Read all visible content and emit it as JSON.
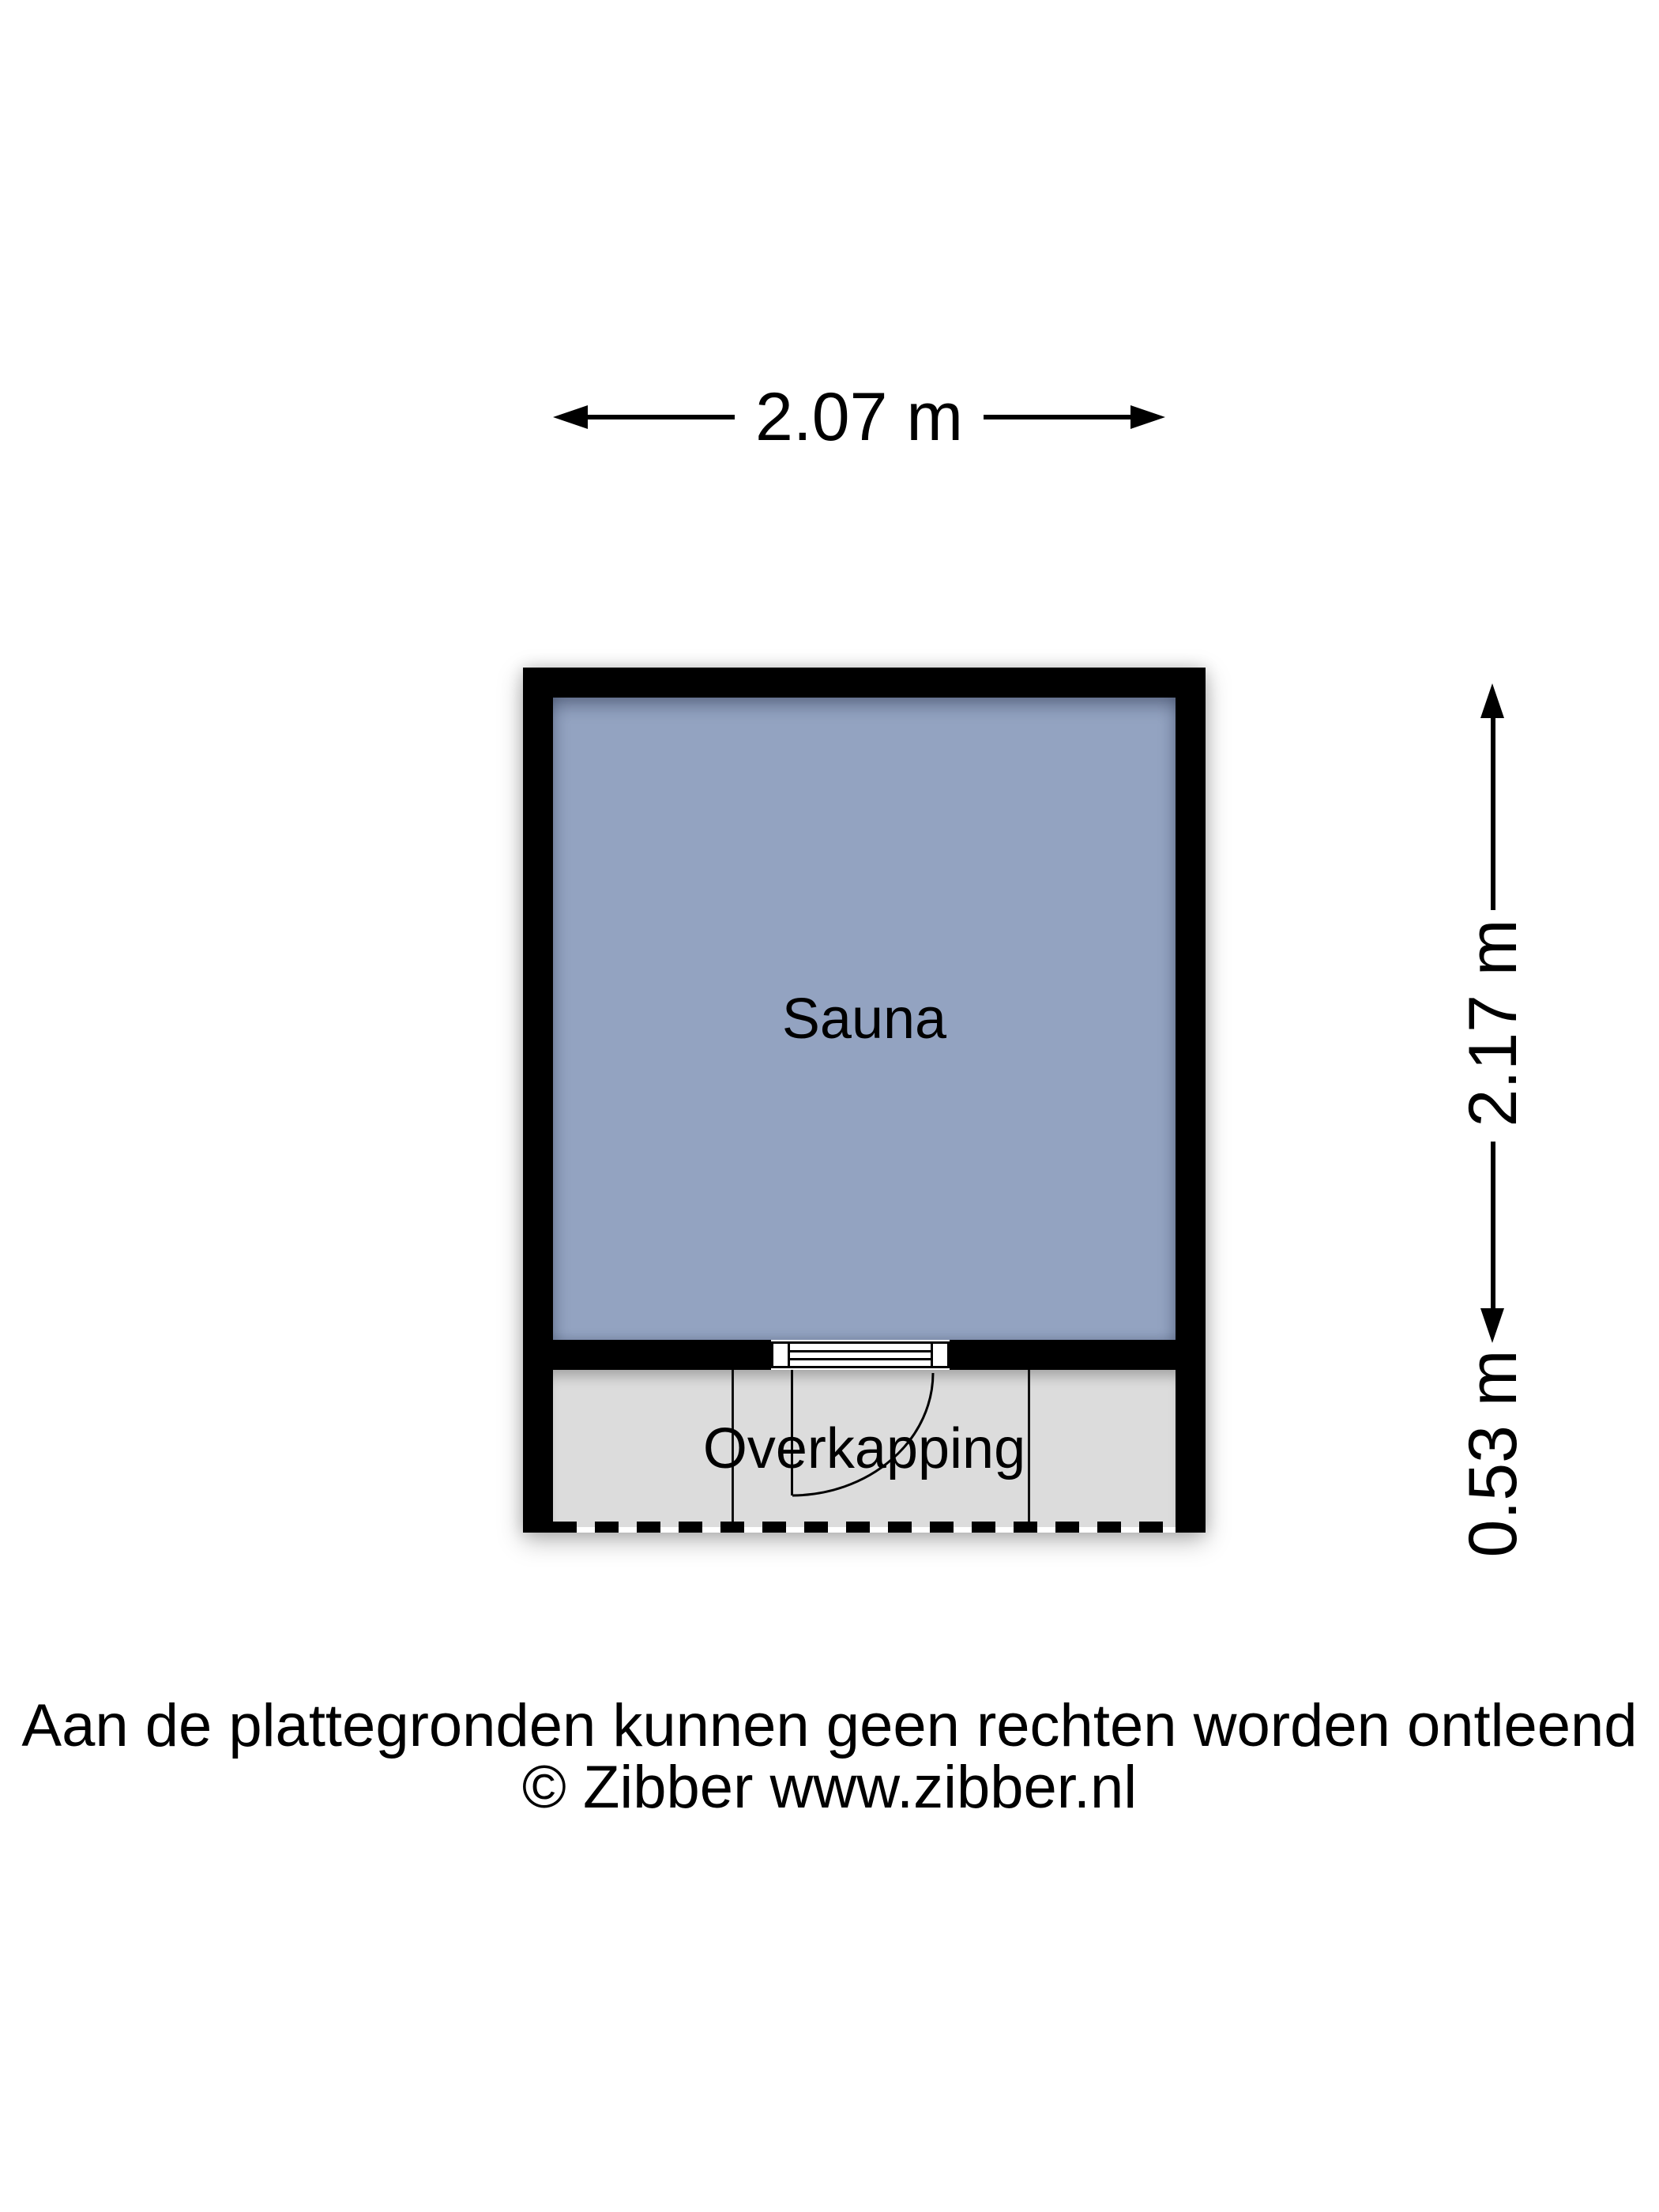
{
  "floor_plan": {
    "rooms": [
      {
        "label": "Sauna"
      },
      {
        "label": "Overkapping"
      }
    ]
  },
  "dimensions": {
    "width": "2.07 m",
    "height_main": "2.17 m",
    "height_overkapping": "0.53 m"
  },
  "footer": {
    "disclaimer": "Aan de plattegronden kunnen geen rechten worden ontleend",
    "copyright": "© Zibber www.zibber.nl"
  },
  "colors": {
    "sauna_fill": "#93a3c1",
    "overkapping_fill": "#dcdcdc",
    "wall": "#000000",
    "background": "#ffffff"
  }
}
